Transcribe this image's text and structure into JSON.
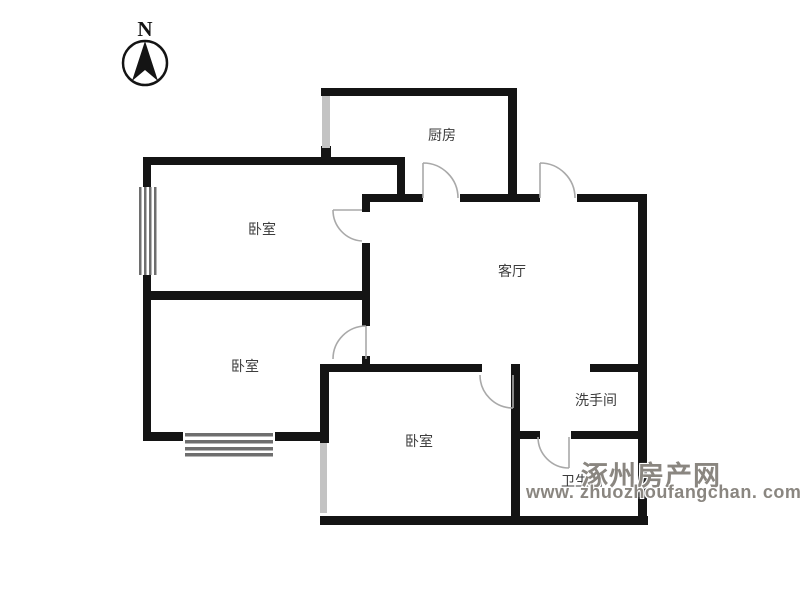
{
  "compass": {
    "label": "N"
  },
  "rooms": {
    "kitchen": {
      "label": "厨房"
    },
    "bedroom_top_left": {
      "label": "卧室"
    },
    "bedroom_middle_left": {
      "label": "卧室"
    },
    "bedroom_bottom": {
      "label": "卧室"
    },
    "living_room": {
      "label": "客厅"
    },
    "washroom": {
      "label": "洗手间"
    },
    "bathroom": {
      "label": "卫生间"
    }
  },
  "watermark": {
    "site_name": "涿州房产网",
    "site_url": "www. zhuozhoufangchan. com"
  },
  "colors": {
    "wall": "#141414",
    "door_arc": "#a9a9a9",
    "window_fill": "#c3c3c3",
    "window_bar": "#6e6e6e",
    "label_text": "#3d3d3d",
    "watermark_text": "#8a8680"
  }
}
